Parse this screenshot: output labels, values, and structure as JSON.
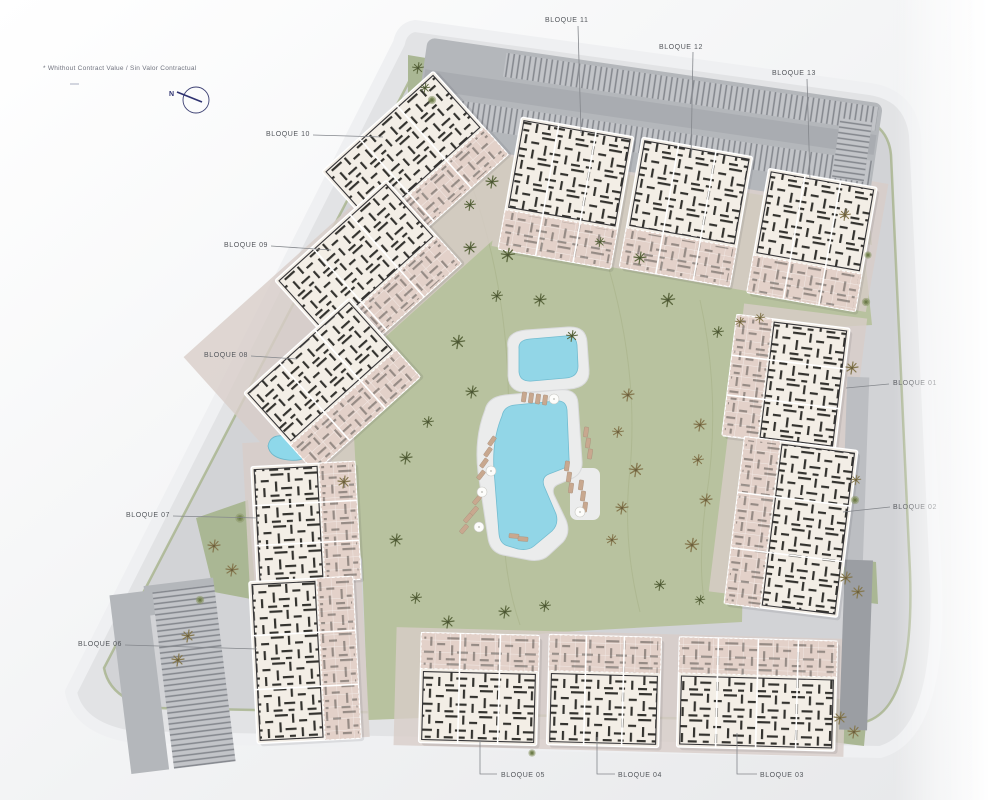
{
  "meta": {
    "disclaimer": "* Whithout Contract Value / Sin Valor Contractual",
    "compass_label": "N"
  },
  "blocks": [
    {
      "id": "bloque-01",
      "label": "BLOQUE 01"
    },
    {
      "id": "bloque-02",
      "label": "BLOQUE 02"
    },
    {
      "id": "bloque-03",
      "label": "BLOQUE 03"
    },
    {
      "id": "bloque-04",
      "label": "BLOQUE 04"
    },
    {
      "id": "bloque-05",
      "label": "BLOQUE 05"
    },
    {
      "id": "bloque-06",
      "label": "BLOQUE 06"
    },
    {
      "id": "bloque-07",
      "label": "BLOQUE 07"
    },
    {
      "id": "bloque-08",
      "label": "BLOQUE 08"
    },
    {
      "id": "bloque-09",
      "label": "BLOQUE 09"
    },
    {
      "id": "bloque-10",
      "label": "BLOQUE 10"
    },
    {
      "id": "bloque-11",
      "label": "BLOQUE 11"
    },
    {
      "id": "bloque-12",
      "label": "BLOQUE 12"
    },
    {
      "id": "bloque-13",
      "label": "BLOQUE 13"
    }
  ],
  "features": {
    "pools": 2,
    "pond": 1,
    "parking_areas": 3
  },
  "colors": {
    "ring": "#e2e3e5",
    "ring_edge": "#eff0f2",
    "paving": "#d2d3d6",
    "court": "#d9cec8",
    "lawn": "#b8c29f",
    "verge": "#a3b086",
    "asphalt": "#b4b7bb",
    "carport": "#c2c4c8",
    "stripe": "#83868c",
    "road_dark": "#9b9ea3",
    "building": "#f3eee6",
    "walls": "#23231f",
    "terrace": "#e3d1c9",
    "deck": "#ebecec",
    "water": "#92d6e7",
    "pond": "#8ed8ea",
    "tree": "#5c683f",
    "bush": "#7c8a57",
    "lounger": "#c8a88f",
    "label_text": "#54575c",
    "leader": "#84878c",
    "compass": "#2e3270",
    "disclaimer_text": "#70737f"
  }
}
